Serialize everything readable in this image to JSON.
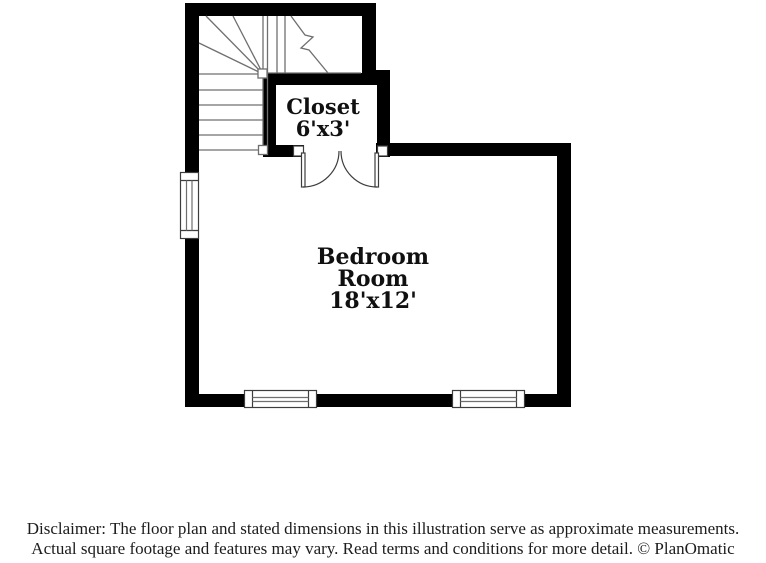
{
  "page": {
    "background": "#ffffff"
  },
  "colors": {
    "wall": "#000000",
    "stair_line": "#6f6f6f",
    "fixture_line": "#3d3d3d",
    "window_inner_line": "#6f6f6f",
    "label_text": "#101010",
    "footer_text": "#1c1c1c"
  },
  "rooms": {
    "closet": {
      "name": "Closet",
      "dims": "6'x3'"
    },
    "bedroom": {
      "name": "Bedroom",
      "name_line2": "Room",
      "dims": "18'x12'"
    }
  },
  "fixtures": {
    "staircase": "winder-staircase-symbol",
    "closet_doors": "double-swing-door-symbol",
    "windows": [
      "left-wall-window",
      "bottom-wall-window-1",
      "bottom-wall-window-2"
    ]
  },
  "footer": {
    "line1": "Disclaimer: The floor plan and stated dimensions in this illustration serve as approximate measurements.",
    "line2": "Actual square footage and features may vary. Read terms and conditions for more detail. © PlanOmatic"
  }
}
